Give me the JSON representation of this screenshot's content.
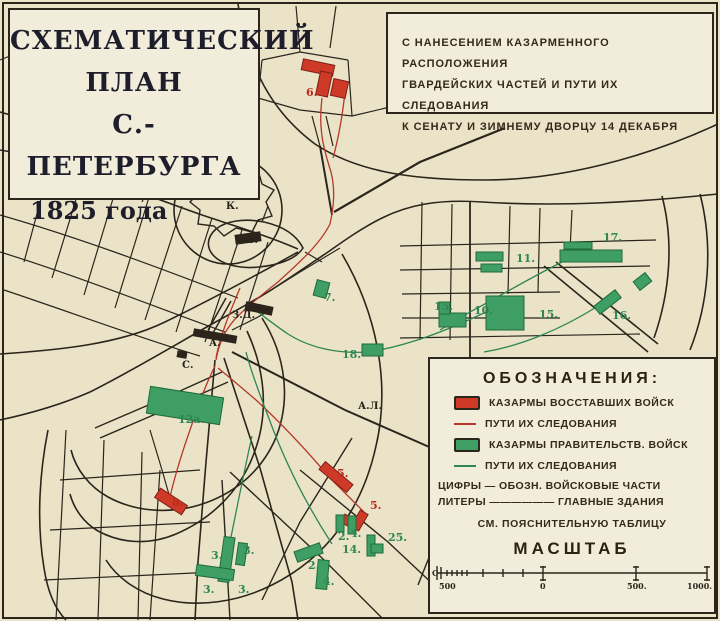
{
  "title_box": {
    "lines": [
      "СХЕМАТИЧЕСКИЙ",
      "ПЛАН",
      "С.-ПЕТЕРБУРГА"
    ],
    "year": "1825 года"
  },
  "subtitle_box": {
    "lines": [
      "С НАНЕСЕНИЕМ КАЗАРМЕННОГО РАСПОЛОЖЕНИЯ",
      "ГВАРДЕЙСКИХ ЧАСТЕЙ И ПУТИ ИХ СЛЕДОВАНИЯ",
      "К СЕНАТУ И ЗИМНЕМУ ДВОРЦУ 14 ДЕКАБРЯ"
    ]
  },
  "legend": {
    "title": "ОБОЗНАЧЕНИЯ:",
    "items": [
      {
        "swatch": "sw-rrect",
        "name": "rebel-barracks-swatch",
        "label": "КАЗАРМЫ ВОССТАВШИХ ВОЙСК"
      },
      {
        "swatch": "sw-rline",
        "name": "rebel-route-swatch",
        "label": "ПУТИ ИХ СЛЕДОВАНИЯ"
      },
      {
        "swatch": "sw-grect",
        "name": "government-barracks-swatch",
        "label": "КАЗАРМЫ ПРАВИТЕЛЬСТВ. ВОЙСК"
      },
      {
        "swatch": "sw-gline",
        "name": "government-route-swatch",
        "label": "ПУТИ ИХ СЛЕДОВАНИЯ"
      }
    ],
    "notes": [
      "ЦИФРЫ — ОБОЗН. ВОЙСКОВЫЕ ЧАСТИ",
      "ЛИТЕРЫ —————— ГЛАВНЫЕ ЗДАНИЯ"
    ],
    "see_note": "СМ. ПОЯСНИТЕЛЬНУЮ ТАБЛИЦУ",
    "scale_title": "МАСШТАБ",
    "scale_labels": [
      {
        "t": "С",
        "x": 1,
        "y": 13
      },
      {
        "t": "500",
        "x": 8,
        "y": 26
      },
      {
        "t": "0",
        "x": 109,
        "y": 26
      },
      {
        "t": "500.",
        "x": 196,
        "y": 26
      },
      {
        "t": "1000.",
        "x": 256,
        "y": 26
      }
    ]
  },
  "colors": {
    "paper": "#eae3c8",
    "panel": "#f2ecda",
    "ink": "#2b251c",
    "rebel_red": "#cf3a28",
    "government_green": "#3f9e63",
    "rebel_route": "#b5382a",
    "government_route": "#2f8653"
  },
  "map": {
    "blocks": [
      {
        "c": "r",
        "x": 302,
        "y": 62,
        "w": 32,
        "h": 11,
        "rot": 12
      },
      {
        "c": "r",
        "x": 318,
        "y": 72,
        "w": 12,
        "h": 24,
        "rot": 12
      },
      {
        "c": "r",
        "x": 332,
        "y": 80,
        "w": 15,
        "h": 17,
        "rot": 12
      },
      {
        "c": "r",
        "x": 155,
        "y": 496,
        "w": 32,
        "h": 11,
        "rot": 33
      },
      {
        "c": "r",
        "x": 318,
        "y": 472,
        "w": 36,
        "h": 10,
        "rot": 40
      },
      {
        "c": "r",
        "x": 355,
        "y": 511,
        "w": 9,
        "h": 19,
        "rot": 30
      },
      {
        "c": "r",
        "x": 342,
        "y": 516,
        "w": 10,
        "h": 9,
        "rot": 30
      },
      {
        "c": "g",
        "x": 148,
        "y": 392,
        "w": 74,
        "h": 27,
        "rot": 9
      },
      {
        "c": "g",
        "x": 362,
        "y": 344,
        "w": 21,
        "h": 12,
        "rot": 0
      },
      {
        "c": "g",
        "x": 315,
        "y": 281,
        "w": 13,
        "h": 16,
        "rot": 15
      },
      {
        "c": "g",
        "x": 476,
        "y": 252,
        "w": 27,
        "h": 9,
        "rot": 0
      },
      {
        "c": "g",
        "x": 481,
        "y": 264,
        "w": 21,
        "h": 8,
        "rot": 0
      },
      {
        "c": "g",
        "x": 560,
        "y": 250,
        "w": 62,
        "h": 12,
        "rot": 0
      },
      {
        "c": "g",
        "x": 564,
        "y": 242,
        "w": 28,
        "h": 7,
        "rot": 0
      },
      {
        "c": "g",
        "x": 439,
        "y": 313,
        "w": 27,
        "h": 14,
        "rot": 0
      },
      {
        "c": "g",
        "x": 439,
        "y": 302,
        "w": 11,
        "h": 12,
        "rot": 0
      },
      {
        "c": "g",
        "x": 486,
        "y": 296,
        "w": 38,
        "h": 34,
        "rot": 0
      },
      {
        "c": "g",
        "x": 594,
        "y": 297,
        "w": 27,
        "h": 10,
        "rot": -38
      },
      {
        "c": "g",
        "x": 635,
        "y": 276,
        "w": 15,
        "h": 11,
        "rot": -38
      },
      {
        "c": "g",
        "x": 221,
        "y": 537,
        "w": 11,
        "h": 45,
        "rot": 8
      },
      {
        "c": "g",
        "x": 196,
        "y": 567,
        "w": 38,
        "h": 11,
        "rot": 8
      },
      {
        "c": "g",
        "x": 237,
        "y": 543,
        "w": 9,
        "h": 22,
        "rot": 8
      },
      {
        "c": "g",
        "x": 336,
        "y": 515,
        "w": 8,
        "h": 17,
        "rot": 0
      },
      {
        "c": "g",
        "x": 348,
        "y": 516,
        "w": 8,
        "h": 18,
        "rot": 0
      },
      {
        "c": "g",
        "x": 367,
        "y": 535,
        "w": 8,
        "h": 21,
        "rot": 0
      },
      {
        "c": "g",
        "x": 371,
        "y": 544,
        "w": 12,
        "h": 9,
        "rot": 0
      },
      {
        "c": "g",
        "x": 295,
        "y": 547,
        "w": 27,
        "h": 11,
        "rot": -20
      },
      {
        "c": "g",
        "x": 317,
        "y": 560,
        "w": 11,
        "h": 29,
        "rot": 5
      },
      {
        "c": "b",
        "x": 193,
        "y": 332,
        "w": 44,
        "h": 8,
        "rot": 10
      },
      {
        "c": "b",
        "x": 245,
        "y": 304,
        "w": 28,
        "h": 9,
        "rot": 12
      },
      {
        "c": "b",
        "x": 235,
        "y": 233,
        "w": 26,
        "h": 10,
        "rot": -8
      },
      {
        "c": "b",
        "x": 177,
        "y": 351,
        "w": 10,
        "h": 7,
        "rot": 10
      }
    ],
    "labels": [
      {
        "c": "r",
        "t": "6.",
        "x": 306,
        "y": 96
      },
      {
        "c": "r",
        "t": "8.",
        "x": 172,
        "y": 506
      },
      {
        "c": "r",
        "t": "5.",
        "x": 337,
        "y": 477
      },
      {
        "c": "r",
        "t": "5.",
        "x": 370,
        "y": 509
      },
      {
        "c": "g",
        "t": "17.",
        "x": 603,
        "y": 241
      },
      {
        "c": "g",
        "t": "11.",
        "x": 516,
        "y": 262
      },
      {
        "c": "g",
        "t": "7.",
        "x": 324,
        "y": 301
      },
      {
        "c": "g",
        "t": "18.",
        "x": 342,
        "y": 358
      },
      {
        "c": "g",
        "t": "12а.",
        "x": 178,
        "y": 423
      },
      {
        "c": "g",
        "t": "15.",
        "x": 434,
        "y": 310
      },
      {
        "c": "g",
        "t": "10.",
        "x": 474,
        "y": 314
      },
      {
        "c": "g",
        "t": "15.",
        "x": 539,
        "y": 318
      },
      {
        "c": "g",
        "t": "16.",
        "x": 612,
        "y": 319
      },
      {
        "c": "g",
        "t": "3.",
        "x": 211,
        "y": 559
      },
      {
        "c": "g",
        "t": "3.",
        "x": 243,
        "y": 554
      },
      {
        "c": "g",
        "t": "3.",
        "x": 203,
        "y": 593
      },
      {
        "c": "g",
        "t": "3.",
        "x": 238,
        "y": 593
      },
      {
        "c": "g",
        "t": "2.",
        "x": 338,
        "y": 540
      },
      {
        "c": "g",
        "t": "4.",
        "x": 350,
        "y": 537
      },
      {
        "c": "g",
        "t": "14.",
        "x": 342,
        "y": 553
      },
      {
        "c": "g",
        "t": "25.",
        "x": 388,
        "y": 541
      },
      {
        "c": "g",
        "t": "2.",
        "x": 308,
        "y": 569
      },
      {
        "c": "g",
        "t": "4.",
        "x": 323,
        "y": 585
      },
      {
        "c": "k",
        "t": "К.",
        "x": 226,
        "y": 209
      },
      {
        "c": "k",
        "t": "Б.",
        "x": 246,
        "y": 243
      },
      {
        "c": "k",
        "t": "З.Д.",
        "x": 232,
        "y": 318
      },
      {
        "c": "k",
        "t": "А.",
        "x": 209,
        "y": 346
      },
      {
        "c": "k",
        "t": "С.",
        "x": 182,
        "y": 368
      },
      {
        "c": "k",
        "t": "А.Л.",
        "x": 358,
        "y": 409
      }
    ]
  }
}
